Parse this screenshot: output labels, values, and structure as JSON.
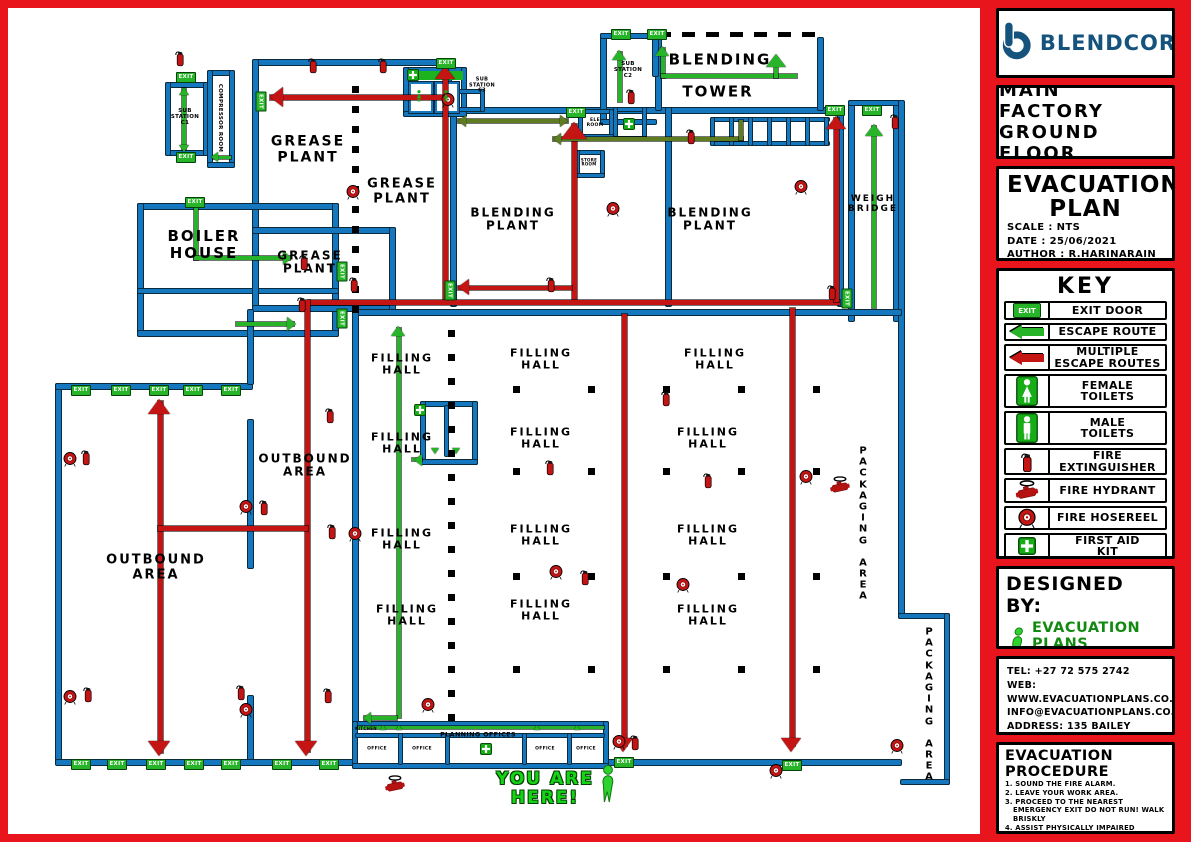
{
  "colors": {
    "frame": "#e8151c",
    "wall_blue": "#1577bd",
    "route_red": "#c41414",
    "route_green": "#28b428",
    "route_olive": "#5e7d20",
    "exit_green": "#28b428",
    "brand_blue": "#15537d"
  },
  "sidebar": {
    "brand": {
      "name": "BLENDCOR"
    },
    "location": {
      "line1": "MAIN FACTORY",
      "line2": "GROUND FLOOR"
    },
    "plan": {
      "title": "EVACUATION\nPLAN",
      "scale": "SCALE : NTS",
      "date": "DATE : 25/06/2021",
      "author": "AUTHOR : R.HARINARAIN"
    },
    "key": {
      "title": "KEY",
      "items": [
        {
          "icon": "exit-door-icon",
          "label": "EXIT DOOR"
        },
        {
          "icon": "escape-route-icon",
          "label": "ESCAPE ROUTE"
        },
        {
          "icon": "multiple-escape-routes-icon",
          "label": "MULTIPLE\nESCAPE ROUTES"
        },
        {
          "icon": "female-toilets-icon",
          "label": "FEMALE\nTOILETS"
        },
        {
          "icon": "male-toilets-icon",
          "label": "MALE\nTOILETS"
        },
        {
          "icon": "fire-extinguisher-icon",
          "label": "FIRE\nEXTINGUISHER"
        },
        {
          "icon": "fire-hydrant-icon",
          "label": "FIRE HYDRANT"
        },
        {
          "icon": "fire-hosereel-icon",
          "label": "FIRE HOSEREEL"
        },
        {
          "icon": "first-aid-kit-icon",
          "label": "FIRST AID\nKIT"
        }
      ]
    },
    "designed_by": {
      "title": "DESIGNED BY:",
      "logo_text": "EVACUATION PLANS",
      "tagline": "THINK SAFETY, ACT FORWARD | CREATING A SAFER TOMORROW"
    },
    "contact": {
      "lines": [
        "TEL: +27 72 575 2742",
        "WEB: WWW.EVACUATIONPLANS.CO.ZA",
        "INFO@EVACUATIONPLANS.CO.ZA",
        "ADDRESS: 135 BAILEY ROAD,",
        "REHILL, DURBAN, 4051"
      ]
    },
    "procedure": {
      "title": "EVACUATION PROCEDURE",
      "steps": [
        "1. SOUND THE FIRE ALARM.",
        "2. LEAVE YOUR WORK AREA.",
        "3. PROCEED TO THE NEAREST EMERGENCY EXIT DO NOT RUN! WALK BRISKLY",
        "4. ASSIST PHYSICALLY IMPAIRED INDIVIDUALS.",
        "5. PROCEED TO THE ASSEMBLY POINT LOCATED OUTSIDE"
      ]
    }
  },
  "map": {
    "exit_label": "EXIT",
    "labels": [
      {
        "t": "SUB\nSTATION\nC1",
        "x": 177,
        "y": 109,
        "fs": 5.5
      },
      {
        "t": "COMPRESSOR ROOM",
        "x": 212,
        "y": 110,
        "fs": 5.5,
        "rot": true
      },
      {
        "t": "GREASE\nPLANT",
        "x": 300,
        "y": 142,
        "fs": 14
      },
      {
        "t": "GREASE\nPLANT",
        "x": 394,
        "y": 184,
        "fs": 13
      },
      {
        "t": "SUB\nSTATION\nC3",
        "x": 474,
        "y": 78,
        "fs": 5
      },
      {
        "t": "SUB\nSTATION\nC2",
        "x": 620,
        "y": 62,
        "fs": 5.5
      },
      {
        "t": "BLENDING",
        "x": 712,
        "y": 52,
        "fs": 15
      },
      {
        "t": "TOWER",
        "x": 710,
        "y": 84,
        "fs": 15
      },
      {
        "t": "BLENDING\nPLANT",
        "x": 505,
        "y": 212,
        "fs": 12
      },
      {
        "t": "BLENDING\nPLANT",
        "x": 702,
        "y": 212,
        "fs": 12
      },
      {
        "t": "WEIGH\nBRIDGE",
        "x": 865,
        "y": 196,
        "fs": 9
      },
      {
        "t": "BOILER\nHOUSE",
        "x": 196,
        "y": 237,
        "fs": 15
      },
      {
        "t": "GREASE\nPLANT",
        "x": 302,
        "y": 255,
        "fs": 12
      },
      {
        "t": "ELE\nROOM",
        "x": 587,
        "y": 115,
        "fs": 4.5
      },
      {
        "t": "STORE\nROOM",
        "x": 581,
        "y": 155,
        "fs": 4
      },
      {
        "t": "FILLING\nHALL",
        "x": 394,
        "y": 357,
        "fs": 11
      },
      {
        "t": "FILLING\nHALL",
        "x": 533,
        "y": 352,
        "fs": 11
      },
      {
        "t": "FILLING\nHALL",
        "x": 707,
        "y": 352,
        "fs": 11
      },
      {
        "t": "FILLING\nHALL",
        "x": 394,
        "y": 436,
        "fs": 11
      },
      {
        "t": "FILLING\nHALL",
        "x": 533,
        "y": 431,
        "fs": 11
      },
      {
        "t": "FILLING\nHALL",
        "x": 700,
        "y": 431,
        "fs": 11
      },
      {
        "t": "FILLING\nHALL",
        "x": 394,
        "y": 532,
        "fs": 11
      },
      {
        "t": "FILLING\nHALL",
        "x": 533,
        "y": 528,
        "fs": 11
      },
      {
        "t": "FILLING\nHALL",
        "x": 700,
        "y": 528,
        "fs": 11
      },
      {
        "t": "FILLING\nHALL",
        "x": 399,
        "y": 608,
        "fs": 11
      },
      {
        "t": "FILLING\nHALL",
        "x": 533,
        "y": 603,
        "fs": 11
      },
      {
        "t": "FILLING\nHALL",
        "x": 700,
        "y": 608,
        "fs": 11
      },
      {
        "t": "OUTBOUND\nAREA",
        "x": 297,
        "y": 458,
        "fs": 12
      },
      {
        "t": "OUTBOUND\nAREA",
        "x": 148,
        "y": 560,
        "fs": 13
      },
      {
        "t": "PACKAGING AREA",
        "x": 855,
        "y": 516,
        "fs": 10,
        "stack": true
      },
      {
        "t": "PACKAGING AREA",
        "x": 921,
        "y": 697,
        "fs": 10,
        "stack": true
      },
      {
        "t": "PLANNING OFFICES",
        "x": 470,
        "y": 727,
        "fs": 6.5
      },
      {
        "t": "KITCHEN",
        "x": 358,
        "y": 721,
        "fs": 4
      },
      {
        "t": "OFFICE",
        "x": 369,
        "y": 741,
        "fs": 4.5
      },
      {
        "t": "OFFICE",
        "x": 414,
        "y": 741,
        "fs": 4.5
      },
      {
        "t": "OFFICE",
        "x": 537,
        "y": 741,
        "fs": 4.5
      },
      {
        "t": "OFFICE",
        "x": 578,
        "y": 741,
        "fs": 4.5
      },
      {
        "t": "YOU ARE\nHERE!",
        "x": 537,
        "y": 781,
        "fs": 17,
        "c": "#15d415",
        "outline": true
      }
    ],
    "exits": [
      [
        252,
        92,
        1
      ],
      [
        177,
        68,
        0
      ],
      [
        177,
        148,
        0
      ],
      [
        186,
        193,
        0
      ],
      [
        333,
        262,
        1
      ],
      [
        333,
        309,
        1
      ],
      [
        441,
        281,
        1
      ],
      [
        437,
        54,
        0
      ],
      [
        567,
        103,
        0
      ],
      [
        612,
        25,
        0
      ],
      [
        648,
        25,
        0
      ],
      [
        826,
        101,
        0
      ],
      [
        863,
        101,
        0
      ],
      [
        72,
        381,
        0
      ],
      [
        112,
        381,
        0
      ],
      [
        150,
        381,
        0
      ],
      [
        184,
        381,
        0
      ],
      [
        222,
        381,
        0
      ],
      [
        72,
        755,
        0
      ],
      [
        108,
        755,
        0
      ],
      [
        147,
        755,
        0
      ],
      [
        185,
        755,
        0
      ],
      [
        222,
        755,
        0
      ],
      [
        273,
        755,
        0
      ],
      [
        320,
        755,
        0
      ],
      [
        615,
        753,
        0
      ],
      [
        783,
        756,
        0
      ],
      [
        838,
        289,
        1
      ]
    ],
    "icons": {
      "fire_extinguisher": [
        [
          172,
          50
        ],
        [
          305,
          57
        ],
        [
          375,
          57
        ],
        [
          887,
          113
        ],
        [
          623,
          88
        ],
        [
          683,
          128
        ],
        [
          543,
          276
        ],
        [
          824,
          284
        ],
        [
          296,
          254
        ],
        [
          294,
          296
        ],
        [
          346,
          276
        ],
        [
          78,
          449
        ],
        [
          256,
          499
        ],
        [
          322,
          407
        ],
        [
          324,
          523
        ],
        [
          80,
          686
        ],
        [
          233,
          684
        ],
        [
          320,
          687
        ],
        [
          627,
          734
        ],
        [
          658,
          390
        ],
        [
          700,
          472
        ],
        [
          542,
          459
        ],
        [
          577,
          569
        ]
      ],
      "fire_hosereel": [
        [
          345,
          184
        ],
        [
          605,
          201
        ],
        [
          793,
          179
        ],
        [
          440,
          92
        ],
        [
          62,
          451
        ],
        [
          238,
          499
        ],
        [
          347,
          526
        ],
        [
          62,
          689
        ],
        [
          238,
          702
        ],
        [
          420,
          697
        ],
        [
          611,
          734
        ],
        [
          768,
          763
        ],
        [
          889,
          738
        ],
        [
          798,
          469
        ],
        [
          548,
          564
        ],
        [
          675,
          577
        ]
      ],
      "fire_hydrant": [
        [
          387,
          776
        ],
        [
          832,
          477
        ]
      ],
      "first_aid": [
        [
          405,
          67
        ],
        [
          412,
          402
        ],
        [
          478,
          741
        ],
        [
          621,
          116
        ]
      ],
      "person": [
        [
          600,
          776
        ]
      ],
      "toilet_figure": [
        [
          411,
          88
        ],
        [
          438,
          88
        ]
      ]
    }
  }
}
